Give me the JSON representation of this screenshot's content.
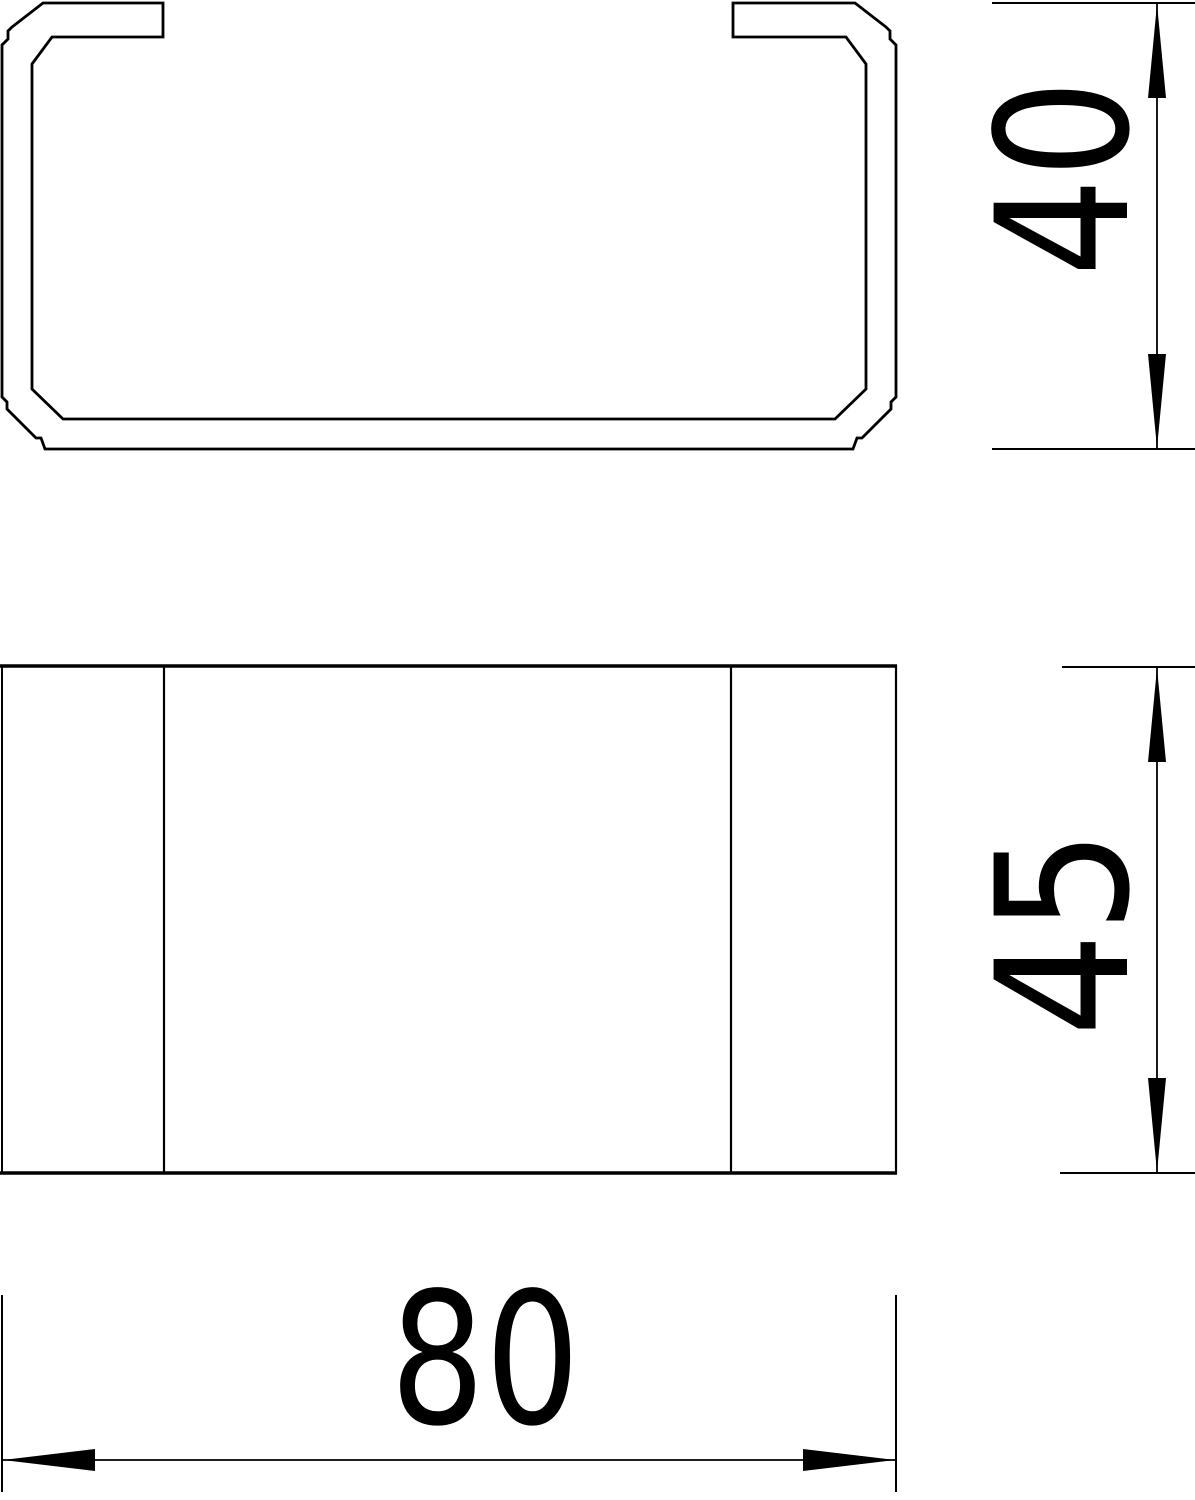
{
  "drawing": {
    "type": "technical-dimension-drawing",
    "background_color": "#ffffff",
    "line_color": "#000000",
    "views": {
      "cross_section": {
        "description": "C-channel trunking profile cross-section with inward lips, chamfered and notched corners"
      },
      "front": {
        "description": "Front view rectangle with two vertical edge lines marking the opening"
      }
    },
    "dimensions": {
      "profile_height": {
        "value": "40",
        "orientation": "vertical",
        "applies_to": "cross-section height"
      },
      "front_height": {
        "value": "45",
        "orientation": "vertical",
        "applies_to": "front view height"
      },
      "width": {
        "value": "80",
        "orientation": "horizontal",
        "applies_to": "overall width"
      }
    }
  }
}
